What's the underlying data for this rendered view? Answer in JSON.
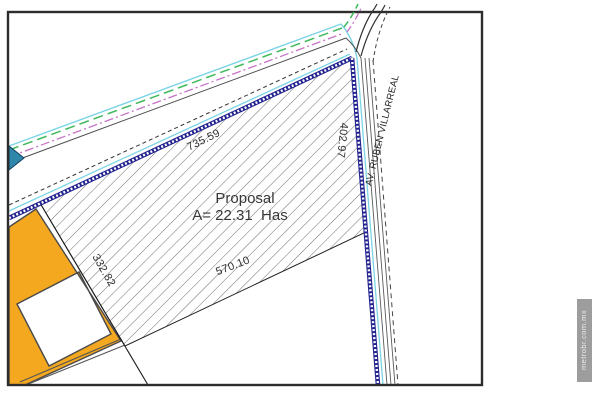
{
  "plan": {
    "proposal": {
      "line1": "Proposal",
      "line2": "A= 22.31  Has"
    },
    "dimensions": {
      "top_boundary": "735.59",
      "right_boundary": "402.97",
      "left_boundary": "332.82",
      "bottom_boundary": "570.10"
    },
    "road": {
      "name": "AV. RUBEN VILLARREAL"
    },
    "watermark": {
      "text": "metrobr.com.mx"
    },
    "colors": {
      "parcel_highlight_orange": "#F3A81F",
      "boundary_navy": "#23238F",
      "utility_cyan": "#7BD4E6",
      "utility_green": "#3FB95B",
      "utility_magenta": "#C773C7",
      "line_gray": "#555555",
      "frame": "#2D2D2D",
      "watermark_bg": "#9D9D9D"
    }
  }
}
